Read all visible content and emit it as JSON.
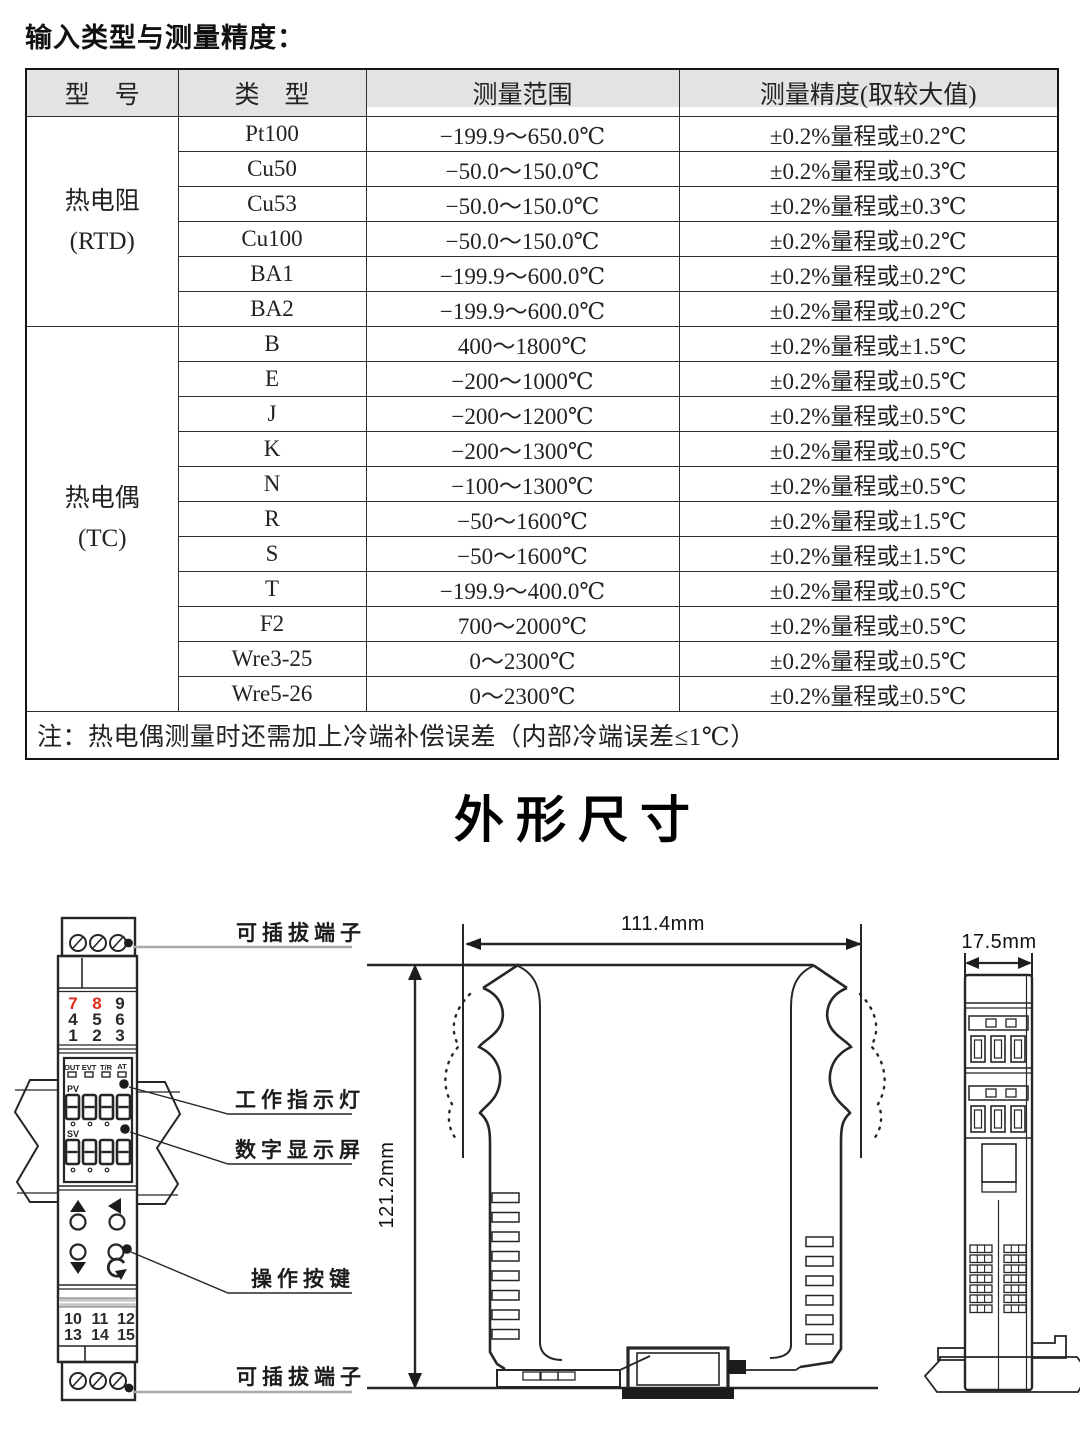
{
  "page_title": "输入类型与测量精度：",
  "table": {
    "headers": [
      "型　号",
      "类　型",
      "测量范围",
      "测量精度(取较大值)"
    ],
    "groups": [
      {
        "model_line1": "热电阻",
        "model_line2": "(RTD)",
        "rows": [
          [
            "Pt100",
            "−199.9～650.0℃",
            "±0.2%量程或±0.2℃"
          ],
          [
            "Cu50",
            "−50.0～150.0℃",
            "±0.2%量程或±0.3℃"
          ],
          [
            "Cu53",
            "−50.0～150.0℃",
            "±0.2%量程或±0.3℃"
          ],
          [
            "Cu100",
            "−50.0～150.0℃",
            "±0.2%量程或±0.2℃"
          ],
          [
            "BA1",
            "−199.9～600.0℃",
            "±0.2%量程或±0.2℃"
          ],
          [
            "BA2",
            "−199.9～600.0℃",
            "±0.2%量程或±0.2℃"
          ]
        ]
      },
      {
        "model_line1": "热电偶",
        "model_line2": "(TC)",
        "rows": [
          [
            "B",
            "400～1800℃",
            "±0.2%量程或±1.5℃"
          ],
          [
            "E",
            "−200～1000℃",
            "±0.2%量程或±0.5℃"
          ],
          [
            "J",
            "−200～1200℃",
            "±0.2%量程或±0.5℃"
          ],
          [
            "K",
            "−200～1300℃",
            "±0.2%量程或±0.5℃"
          ],
          [
            "N",
            "−100～1300℃",
            "±0.2%量程或±0.5℃"
          ],
          [
            "R",
            "−50～1600℃",
            "±0.2%量程或±1.5℃"
          ],
          [
            "S",
            "−50～1600℃",
            "±0.2%量程或±1.5℃"
          ],
          [
            "T",
            "−199.9～400.0℃",
            "±0.2%量程或±0.5℃"
          ],
          [
            "F2",
            "700～2000℃",
            "±0.2%量程或±0.5℃"
          ],
          [
            "Wre3-25",
            "0～2300℃",
            "±0.2%量程或±0.5℃"
          ],
          [
            "Wre5-26",
            "0～2300℃",
            "±0.2%量程或±0.5℃"
          ]
        ]
      }
    ],
    "note": "注：热电偶测量时还需加上冷端补偿误差（内部冷端误差≤1℃）"
  },
  "outline_section": {
    "heading": "外形尺寸",
    "dimensions": {
      "width": "111.4mm",
      "height": "121.2mm",
      "depth": "17.5mm"
    },
    "front_view": {
      "callouts": {
        "top_terminal": "可插拔端子",
        "indicator": "工作指示灯",
        "display": "数字显示屏",
        "buttons": "操作按键",
        "bottom_terminal": "可插拔端子"
      },
      "top_terminal_numbers": {
        "r1": [
          "7",
          "8",
          "9"
        ],
        "r2": [
          "4",
          "5",
          "6"
        ],
        "r3": [
          "1",
          "2",
          "3"
        ]
      },
      "red_number_color": "#e02a1c",
      "indicator_labels": [
        "OUT",
        "EVT",
        "T/R",
        "AT"
      ],
      "pv": "PV",
      "sv": "SV",
      "bottom_terminal_numbers": {
        "r1": [
          "10",
          "11",
          "12"
        ],
        "r2": [
          "13",
          "14",
          "15"
        ]
      }
    }
  }
}
